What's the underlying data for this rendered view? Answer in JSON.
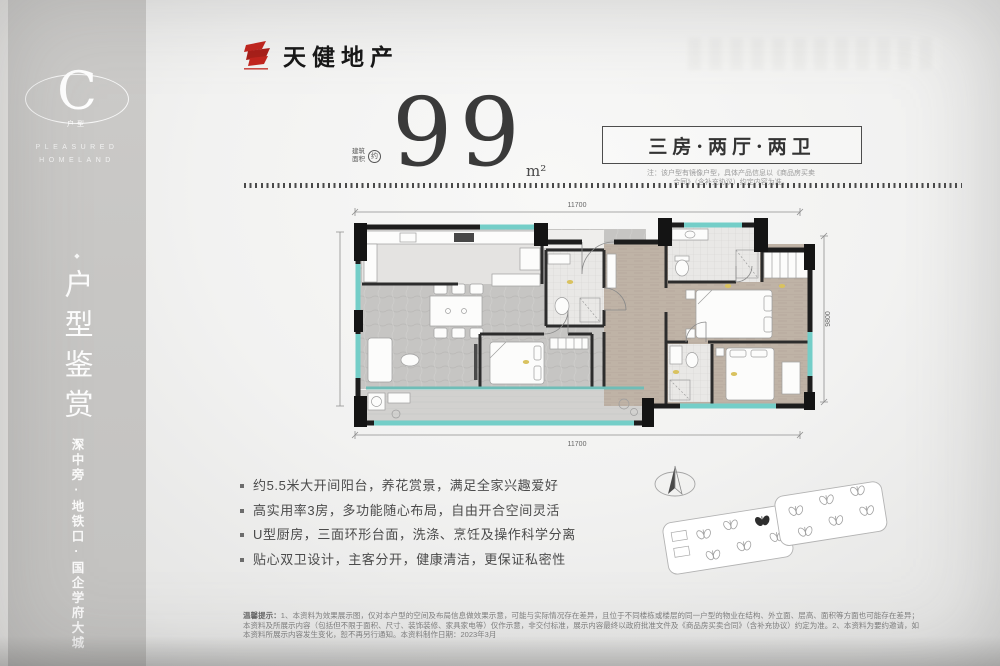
{
  "colors": {
    "accent_red": "#c2231c",
    "wall_dark": "#1d1d1d",
    "window_teal": "#74cec8",
    "sidebar_gray": "#c7c6c4",
    "marker_yellow": "#d9c25f"
  },
  "sidebar": {
    "badge_letter": "C",
    "badge_caption": "户型",
    "tagline_1": "PLEASURED",
    "tagline_2": "HOMELAND",
    "ornament_top": "◆",
    "ornament_bottom": "◆",
    "vertical_title": "户型鉴赏",
    "vertical_subtitle": "深中旁·地铁口·国企学府大城"
  },
  "header": {
    "brand_name": "天健地产"
  },
  "headline": {
    "area_label_1": "建筑",
    "area_label_2": "面积",
    "area_label_circle": "约",
    "area_value": "99",
    "area_unit": "m²",
    "unit_type": "三房·两厅·两卫",
    "note_1": "注：该户型有镜像户型，具体产品信息以《商品房买卖",
    "note_2": "合同》（含补充协议）约定内容为准。"
  },
  "floorplan": {
    "dim_top": "11700",
    "dim_bottom": "11700",
    "dim_right": "9800"
  },
  "features": {
    "items": [
      "约5.5米大开间阳台，养花赏景，满足全家兴趣爱好",
      "高实用率3房，多功能随心布局，自由开合空间灵活",
      "U型厨房，三面环形台面，洗涤、烹饪及操作科学分离",
      "贴心双卫设计，主客分开，健康清洁，更保证私密性"
    ]
  },
  "disclaimer": {
    "label": "温馨提示：",
    "body": "1、本资料为效果展示图，仅对本户型的空间及布局信息做效果示意，可能与实际情况存在差异，且位于不同楼栋或楼层的同一户型的物业在结构、外立面、层高、面积等方面也可能存在差异；本资料及所展示内容（包括但不限于面积、尺寸、装饰装修、家具家电等）仅作示意，非交付标准，展示内容最终以政府批准文件及《商品房买卖合同》（含补充协议）约定为准。2、本资料为要约邀请，如本资料所展示内容发生变化，恕不再另行通知。本资料制作日期：2023年3月"
  }
}
